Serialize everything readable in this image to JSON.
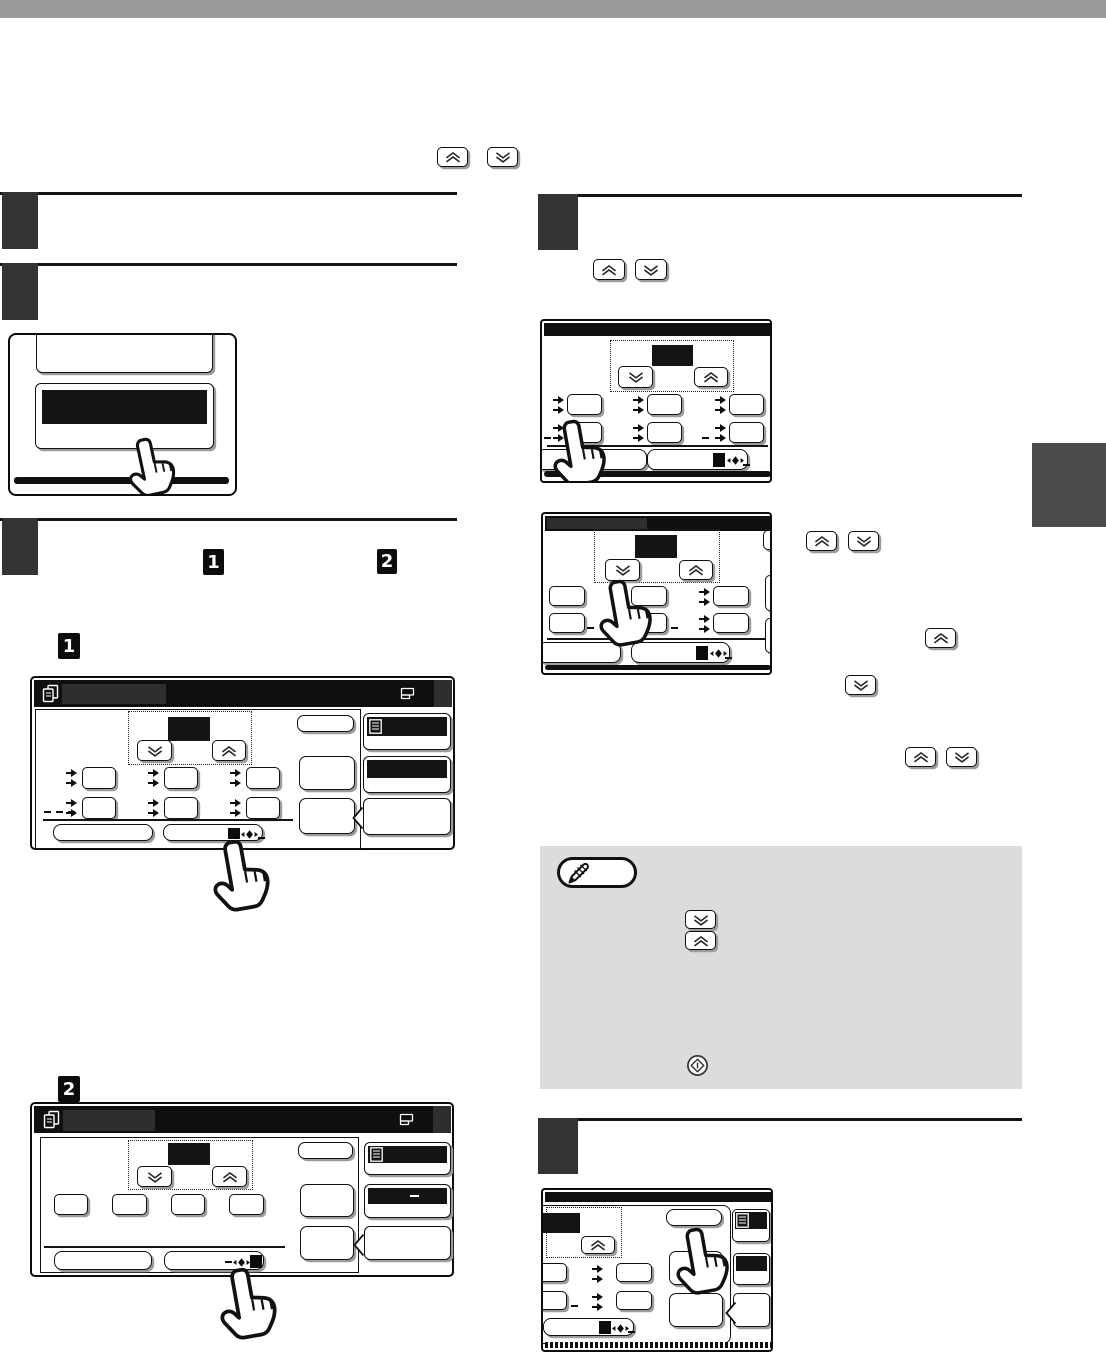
{
  "page": {
    "kind": "copier-manual-page-graphics-only",
    "top_bar_color": "#9a9a9a",
    "side_tab_color": "#4b4b4b",
    "note_box_color": "#dcdcdc",
    "step_box_color": "#333333",
    "ink_color": "#101010",
    "title_bar_color": "#0f0f0f",
    "title_placeholder_color": "#2e2e2e"
  },
  "step_markers": {
    "part1": "1",
    "part2": "2"
  },
  "icons": {
    "hand": "pointing-hand-cursor",
    "chev_up": "double-chevron-up-key",
    "chev_down": "double-chevron-down-key",
    "doc": "copy-screen-pages",
    "printer": "output-tray",
    "list": "job-list",
    "pencil": "note-pencil",
    "start": "start-key-diamond-circle",
    "adjust": "diamond-left-right-arrows",
    "notch": "callout-notch"
  }
}
